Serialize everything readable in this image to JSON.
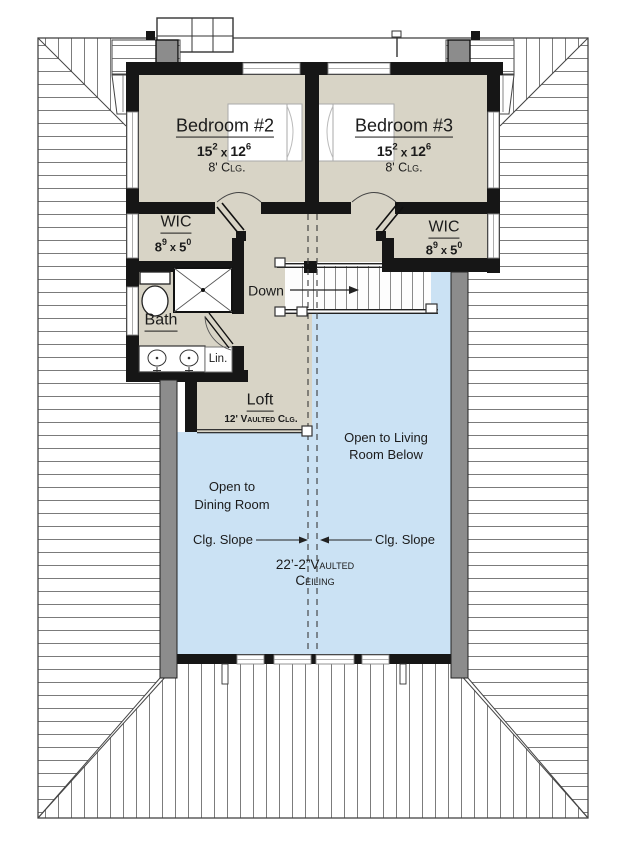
{
  "title": "Second Floor Plan",
  "colors": {
    "room_fill": "#d8d4c6",
    "open_fill": "#cbe2f4",
    "wall": "#161616",
    "roof_line": "#4a4a4a",
    "ext_gray": "#8c8c8c"
  },
  "rooms": {
    "bedroom2": {
      "name": "Bedroom #2",
      "dim": {
        "a": "15",
        "a_sup": "2",
        "sep": "x",
        "b": "12",
        "b_sup": "6"
      },
      "ceiling": "8' Clg."
    },
    "bedroom3": {
      "name": "Bedroom #3",
      "dim": {
        "a": "15",
        "a_sup": "2",
        "sep": "x",
        "b": "12",
        "b_sup": "6"
      },
      "ceiling": "8' Clg."
    },
    "wic_left": {
      "name": "WIC",
      "dim": {
        "a": "8",
        "a_sup": "9",
        "sep": "x",
        "b": "5",
        "b_sup": "0"
      }
    },
    "wic_right": {
      "name": "WIC",
      "dim": {
        "a": "8",
        "a_sup": "9",
        "sep": "x",
        "b": "5",
        "b_sup": "0"
      }
    },
    "bath": {
      "name": "Bath"
    },
    "linen": {
      "name": "Lin."
    },
    "loft": {
      "name": "Loft",
      "ceiling": "12' Vaulted Clg."
    }
  },
  "annotations": {
    "down": "Down",
    "open_living_line1": "Open to Living",
    "open_living_line2": "Room Below",
    "open_dining_line1": "Open to",
    "open_dining_line2": "Dining Room",
    "clg_slope_left": "Clg. Slope",
    "clg_slope_right": "Clg. Slope",
    "vaulted_line1": "22’-2”Vaulted",
    "vaulted_line2": "Ceiling"
  }
}
